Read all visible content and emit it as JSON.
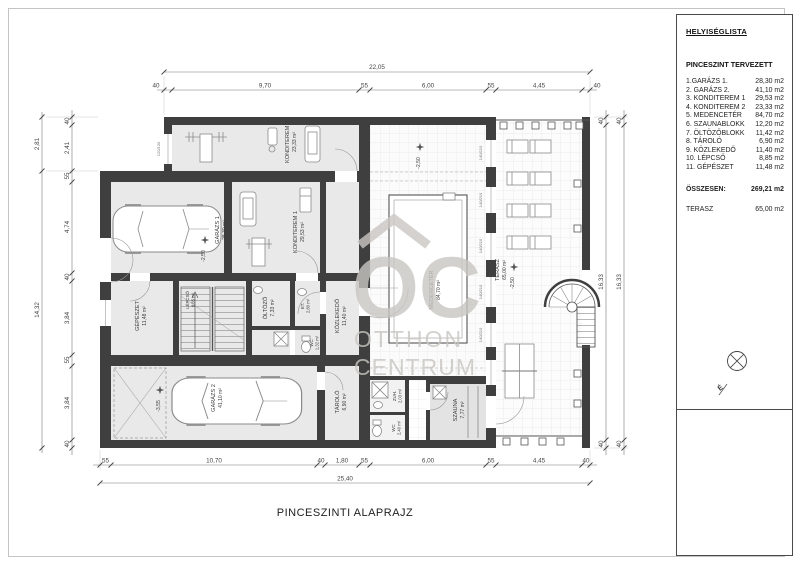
{
  "title": "PINCESZINTI ALAPRAJZ",
  "panel": {
    "heading": "HELYISÉGLISTA",
    "subheading": "PINCESZINT TERVEZETT",
    "rows": [
      {
        "name": "1.GARÁZS 1.",
        "area": "28,30 m2"
      },
      {
        "name": "2. GARÁZS 2.",
        "area": "41,10 m2"
      },
      {
        "name": "3. KONDITEREM 1",
        "area": "29,53 m2"
      },
      {
        "name": "4. KONDITEREM 2",
        "area": "23,33 m2"
      },
      {
        "name": "5. MEDENCETÉR",
        "area": "84,70 m2"
      },
      {
        "name": "6. SZAUNABLOKK",
        "area": "12,20 m2"
      },
      {
        "name": "7. ÖLTÖZŐBLOKK",
        "area": "11,42 m2"
      },
      {
        "name": "8. TÁROLÓ",
        "area": "6,90 m2"
      },
      {
        "name": "9. KÖZLEKEDŐ",
        "area": "11,40 m2"
      },
      {
        "name": "10. LÉPCSŐ",
        "area": "8,85 m2"
      },
      {
        "name": "11. GÉPÉSZET",
        "area": "11,48 m2"
      }
    ],
    "total": {
      "label": "ÖSSZESEN:",
      "area": "269,21 m2"
    },
    "terrace": {
      "label": "TERASZ",
      "area": "65,00 m2"
    },
    "north": "É"
  },
  "plan": {
    "rooms": {
      "garazs1": {
        "name": "GARÁZS 1",
        "area": "28,30 m²"
      },
      "garazs2": {
        "name": "GARÁZS 2",
        "area": "41,10 m²"
      },
      "konditerem1": {
        "name": "KONDITEREM 1",
        "area": "29,53 m²"
      },
      "konditerem2": {
        "name": "KONDITEREM 2",
        "area": "23,33 m²"
      },
      "medenceter": {
        "name": "MEDENCETÉR",
        "area": "84,70 m²"
      },
      "terasz": {
        "name": "TERASZ",
        "area": "65,00 m²"
      },
      "szauna": {
        "name": "SZAUNA",
        "area": "7,77 m²"
      },
      "zuhanyzo": {
        "name": "ZUH.",
        "area": "2,03 m²"
      },
      "wc_kozep": {
        "name": "WC",
        "area": "1,32 m²"
      },
      "wc_szauna": {
        "name": "WC",
        "area": "2,40 m²"
      },
      "et": {
        "name": "ET.",
        "area": "2,80 m²"
      },
      "oltozo": {
        "name": "ÖLTÖZŐ",
        "area": "7,33 m²"
      },
      "tarolo": {
        "name": "TÁROLÓ",
        "area": "6,90 m²"
      },
      "kozlekedo": {
        "name": "KÖZLEKEDŐ",
        "area": "11,40 m²"
      },
      "lepcso": {
        "name": "LÉPCSŐ",
        "area": "8,85 m²"
      },
      "gepeszet": {
        "name": "GÉPÉSZET",
        "area": "11,48 m²"
      }
    },
    "levels": {
      "garazs1": "-2,50",
      "medence": "-2,50",
      "terasz": "-2,50",
      "garazs2": "-3,55"
    },
    "windows": {
      "pool": "140/210",
      "gym": "120/130"
    },
    "dims": {
      "top": {
        "total": "22,05",
        "segments": [
          "40",
          "9,70",
          "55",
          "6,00",
          "55",
          "4,45",
          "40"
        ]
      },
      "bottom": {
        "total": "25,40",
        "segments": [
          "55",
          "10,70",
          "40",
          "1,80",
          "55",
          "6,00",
          "55",
          "4,45",
          "40"
        ]
      },
      "left": {
        "outer": [
          "2,81",
          "14,32"
        ],
        "segments": [
          "40",
          "2,41",
          "55",
          "4,74",
          "40",
          "3,84",
          "55",
          "3,84",
          "40"
        ]
      },
      "right": {
        "inner": [
          "40",
          "16,33",
          "40"
        ],
        "outer": [
          "40",
          "16,33",
          "40"
        ]
      }
    }
  },
  "watermark": {
    "logo": "OC",
    "line1": "OTTHON",
    "line2": "CENTRUM"
  }
}
